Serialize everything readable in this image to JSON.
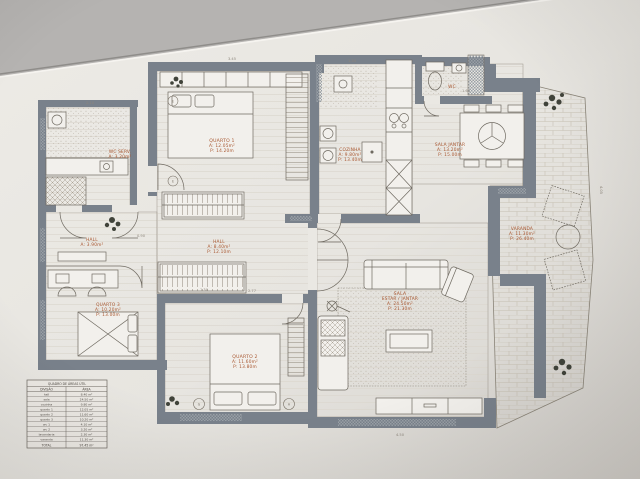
{
  "photo": {
    "description": "architectural floor plan drawing on paper"
  },
  "rooms": {
    "wc_servico": {
      "l1": "WC SERV.",
      "l2": "A: 3.20m²"
    },
    "quarto1": {
      "l1": "QUARTO 1",
      "l2": "A: 12.05m²",
      "l3": "P: 14.20m"
    },
    "hall_entrada": {
      "l1": "HALL",
      "l2": "A: 3.90m²"
    },
    "hall": {
      "l1": "HALL",
      "l2": "A: 8.40m²",
      "l3": "P: 12.10m"
    },
    "cozinha": {
      "l1": "COZINHA",
      "l2": "A: 9.80m²",
      "l3": "P: 13.40m"
    },
    "wc": {
      "l1": "WC"
    },
    "sala_jantar": {
      "l1": "SALA JANTAR",
      "l2": "A: 13.20m²",
      "l3": "P: 15.00m"
    },
    "varanda": {
      "l1": "VARANDA",
      "l2": "A: 11.30m²",
      "l3": "P: 26.40m"
    },
    "sala_estar": {
      "l1": "SALA",
      "l2": "ESTAR / JANTAR",
      "l3": "A: 24.50m²",
      "l4": "P: 21.30m"
    },
    "quarto2": {
      "l1": "QUARTO 2",
      "l2": "A: 11.60m²",
      "l3": "P: 13.80m"
    },
    "quarto3": {
      "l1": "QUARTO 3",
      "l2": "A: 10.20m²",
      "l3": "P: 13.00m"
    }
  },
  "dims": [
    "3.45",
    "2.10",
    "1.34",
    "1.60",
    "1.30",
    "2.77",
    "4.05",
    "4.50",
    "0.90"
  ],
  "markers": [
    "E",
    "E",
    "G",
    "A"
  ],
  "table": {
    "title": "QUADRO DE ÁREAS ÚTIL",
    "col_division": "DIVISÃO",
    "col_area": "ÁREA",
    "rows": [
      {
        "label": "hall",
        "value": "8.40 m²"
      },
      {
        "label": "sala",
        "value": "24.50 m²"
      },
      {
        "label": "cozinha",
        "value": "9.80 m²"
      },
      {
        "label": "quarto 1",
        "value": "12.05 m²"
      },
      {
        "label": "quarto 2",
        "value": "11.60 m²"
      },
      {
        "label": "quarto 3",
        "value": "10.20 m²"
      },
      {
        "label": "wc 1",
        "value": "4.10 m²"
      },
      {
        "label": "wc 2",
        "value": "3.20 m²"
      },
      {
        "label": "lavandaria",
        "value": "2.30 m²"
      },
      {
        "label": "varanda",
        "value": "11.30 m²"
      }
    ],
    "total_label": "TOTAL",
    "total_value": "97.45 m²"
  },
  "colors": {
    "wall": "#79818b",
    "paper": "#eae8e3",
    "background": "#bdbbb9",
    "label_accent": "#a8562f",
    "line": "#7a7268"
  }
}
